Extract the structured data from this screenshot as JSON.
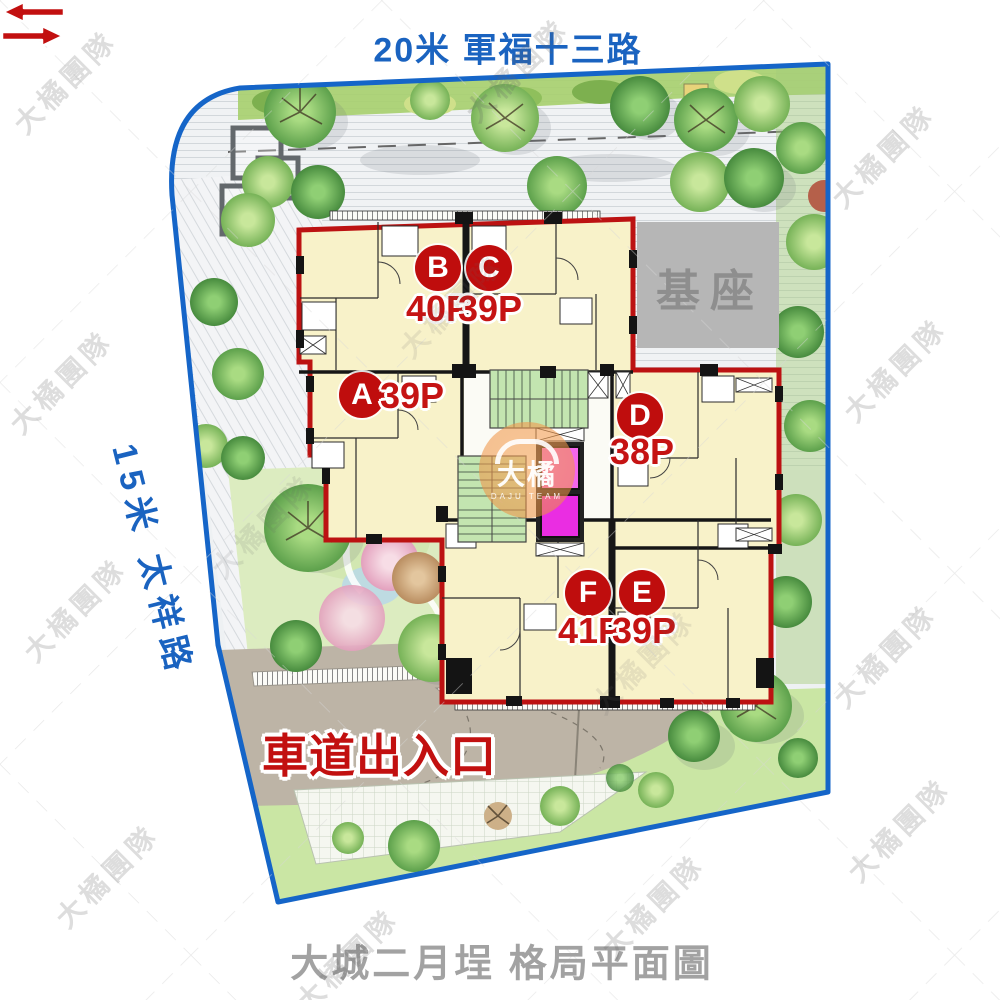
{
  "title_caption": "大城二月埕 格局平面圖",
  "roads": {
    "top": "20米 軍福十三路",
    "left": "15米 太祥路"
  },
  "plan": {
    "base_label": "基座",
    "driveway_label": "車道出入口",
    "units": [
      {
        "label": "A",
        "area": "39P"
      },
      {
        "label": "B",
        "area": "40P"
      },
      {
        "label": "C",
        "area": "39P"
      },
      {
        "label": "D",
        "area": "38P"
      },
      {
        "label": "E",
        "area": "39P"
      },
      {
        "label": "F",
        "area": "41P"
      }
    ]
  },
  "watermark": {
    "team": "大橘團隊",
    "logo_main": "大橘",
    "logo_sub": "DAJU TEAM"
  },
  "colors": {
    "road_blue": "#1a63c0",
    "boundary_blue": "#1565c8",
    "plan_outline_red": "#bc1212",
    "unit_badge_red": "#bf0d0d",
    "unit_fill_cream": "#f8f2c9",
    "base_gray": "#b6b6b6",
    "stair_green": "#c3e5b0",
    "elevator_magenta": "#ee3bee",
    "caption_gray": "#a2a2a2",
    "driveway_taupe": "#bdb4a6"
  }
}
